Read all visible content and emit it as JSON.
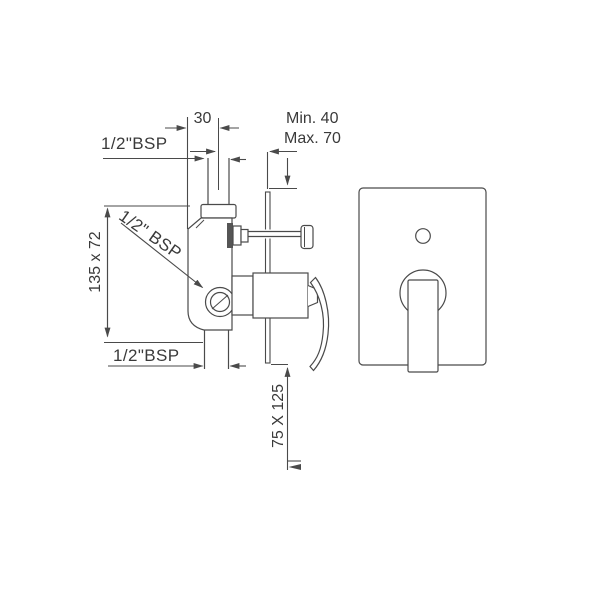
{
  "drawing": {
    "type": "technical-installation-diagram",
    "subject": "concealed shower mixer valve - side section and front plate view",
    "labels": {
      "pipe_offset": "30",
      "inlet_thread_top": "1/2\"BSP",
      "depth_min": "Min. 40",
      "depth_max": "Max. 70",
      "body_size": "135 x 72",
      "inlet_thread_side": "1/2\" BSP",
      "outlet_thread_bottom": "1/2\"BSP",
      "plate_size": "75 X 125"
    },
    "colors": {
      "line": "#4a4a4a",
      "text": "#3a3a3a",
      "background": "#ffffff",
      "diverter_flange_fill": "#555555"
    }
  }
}
